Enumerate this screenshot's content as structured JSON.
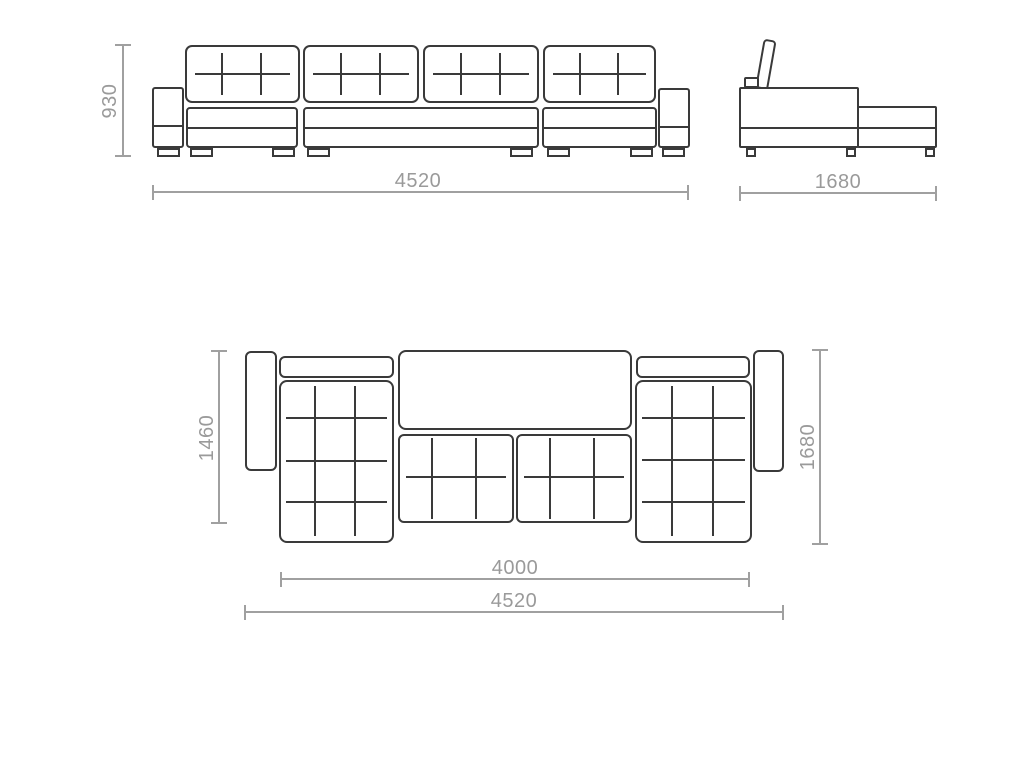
{
  "drawing": {
    "title": "sofa-technical-drawing",
    "colors": {
      "outline": "#3a3a3a",
      "dimension_line": "#a0a0a0",
      "dimension_text": "#9a9a9a",
      "background": "#ffffff"
    },
    "dimensions": {
      "front_height": "930",
      "front_width": "4520",
      "side_depth": "1680",
      "top_inner_depth": "1460",
      "top_depth": "1680",
      "top_inner_width": "4000",
      "top_width": "4520"
    }
  }
}
